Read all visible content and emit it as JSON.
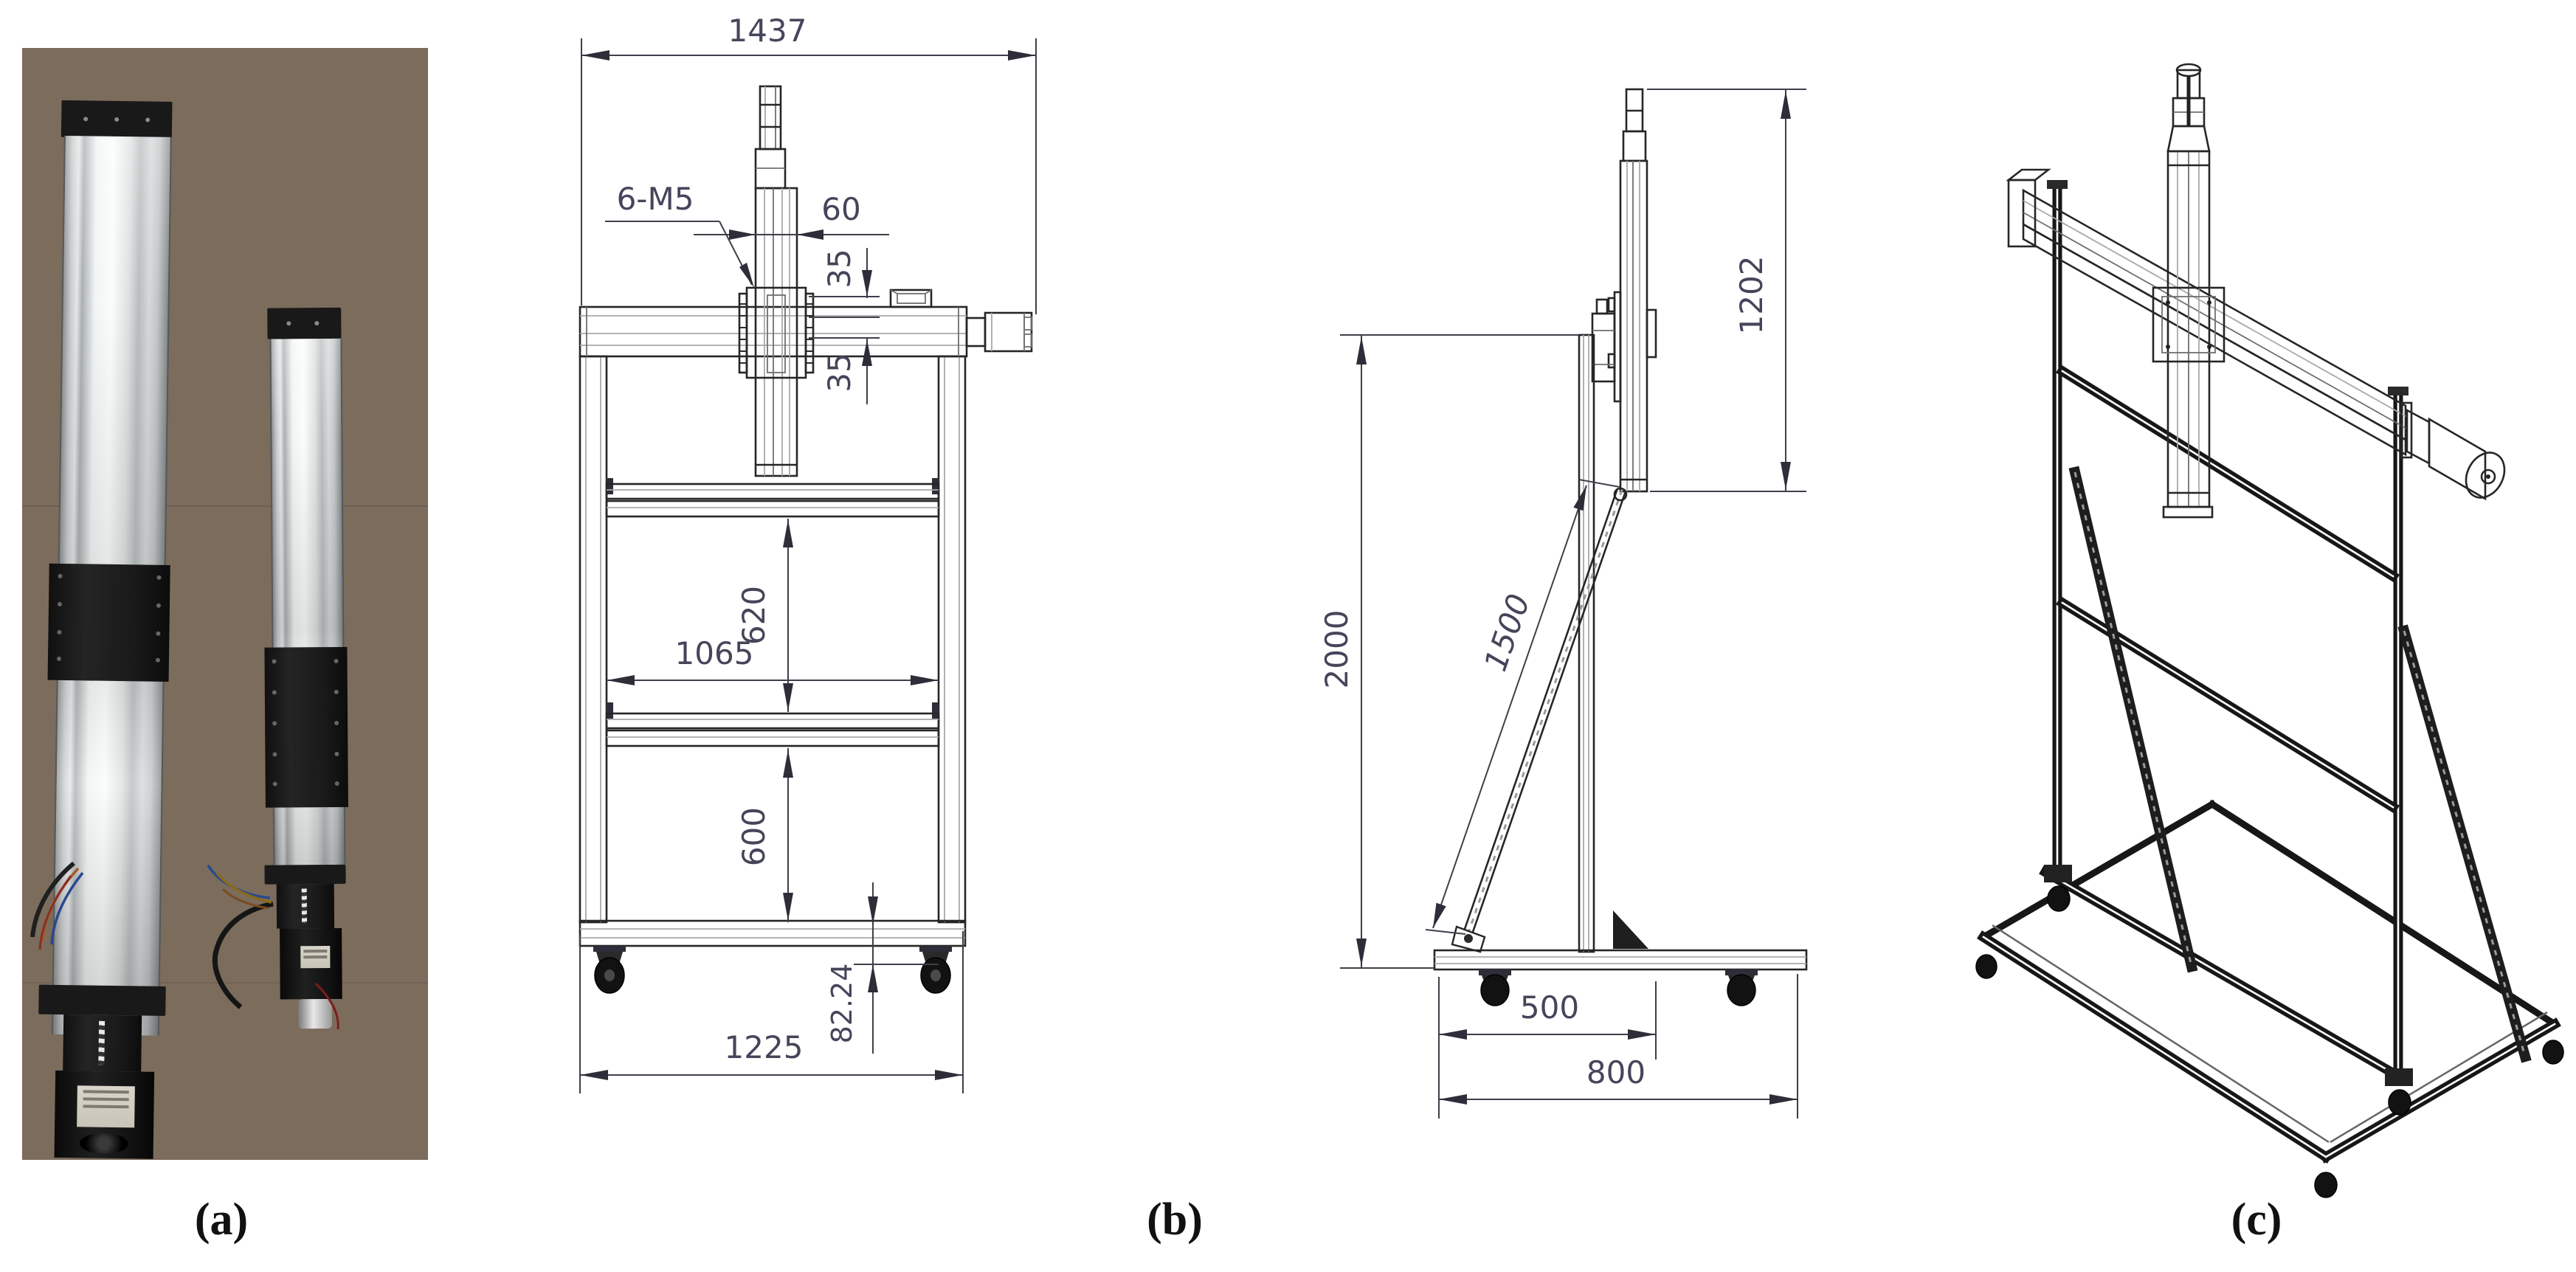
{
  "figure": {
    "panels": [
      {
        "id": "a",
        "label": "(a)"
      },
      {
        "id": "b",
        "label": "(b)"
      },
      {
        "id": "c",
        "label": "(c)"
      }
    ]
  },
  "front_view": {
    "dims": {
      "total_width": "1437",
      "thread_callout": "6-M5",
      "rail_width": "60",
      "flange_top": "35",
      "flange_bottom": "35",
      "upper_bay": "620",
      "inner_width": "1065",
      "lower_bay": "600",
      "caster_height": "82.24",
      "base_width": "1225"
    }
  },
  "side_view": {
    "dims": {
      "overall_height": "2000",
      "brace_length": "1500",
      "vertical_rail_length": "1202",
      "front_depth": "500",
      "base_depth": "800"
    }
  },
  "colors": {
    "drawing_line": "#262626",
    "dimension_text": "#45455a",
    "photo_background": "#7b6c5c",
    "metal_bright": "#f2f4f4",
    "black_hardware": "#161616"
  }
}
